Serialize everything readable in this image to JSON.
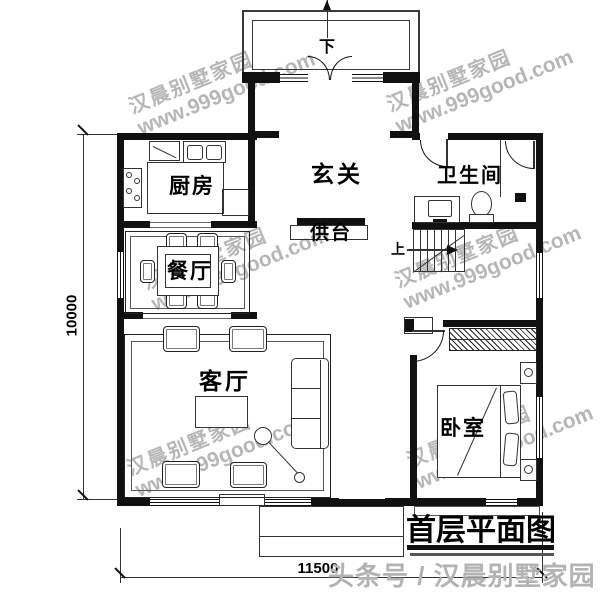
{
  "plan": {
    "rooms": {
      "kitchen": "厨房",
      "dining": "餐厅",
      "hall": "玄关",
      "altar": "供台",
      "bathroom": "卫生间",
      "living": "客厅",
      "bedroom": "卧室"
    },
    "stairs": {
      "up": "上",
      "down": "下"
    },
    "dims": {
      "height": "10000",
      "width": "11500"
    }
  },
  "title": "首层平面图",
  "watermark": {
    "brand": "汉晨别墅家园",
    "url": "www.999good.com"
  },
  "footer": "头条号 / 汉晨别墅家园",
  "colors": {
    "wall": "#111111",
    "line": "#333333",
    "porch_gray": "#3a3a3a",
    "watermark_gray": "#7a7a7a",
    "footer_gray": "#b3b3b3"
  }
}
